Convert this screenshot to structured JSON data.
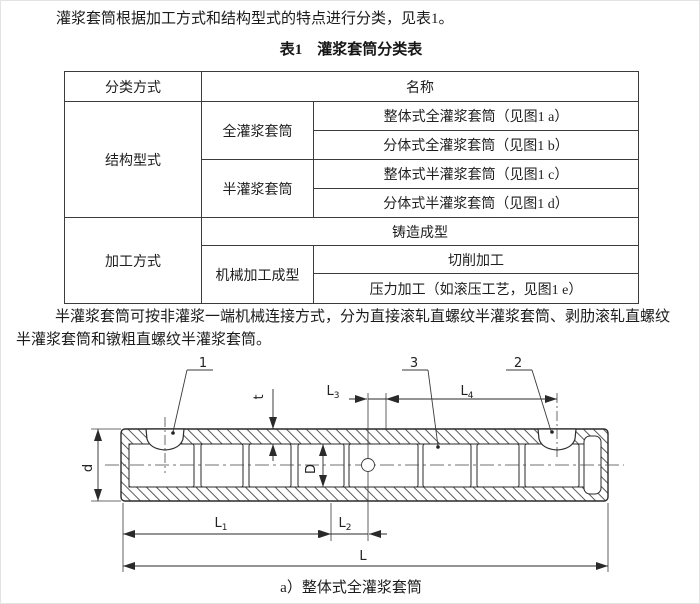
{
  "document": {
    "intro": "灌浆套筒根据加工方式和结构型式的特点进行分类，见表1。",
    "paragraph_lines": [
      "半灌浆套筒可按非灌浆一端机械连接方式，分为直接滚轧直螺纹半灌浆套筒、剥肋滚轧直螺纹",
      "半灌浆套筒和镦粗直螺纹半灌浆套筒。"
    ]
  },
  "table": {
    "title": "表1　灌浆套筒分类表",
    "header": {
      "classification": "分类方式",
      "name": "名称"
    },
    "structure": {
      "label": "结构型式",
      "full": {
        "label": "全灌浆套筒",
        "integral": "整体式全灌浆套筒（见图1 a）",
        "split": "分体式全灌浆套筒（见图1 b）"
      },
      "half": {
        "label": "半灌浆套筒",
        "integral": "整体式半灌浆套筒（见图1 c）",
        "split": "分体式半灌浆套筒（见图1 d）"
      }
    },
    "process": {
      "label": "加工方式",
      "casting": "铸造成型",
      "machining": {
        "label": "机械加工成型",
        "cutting": "切削加工",
        "pressing": "压力加工（如滚压工艺，见图1 e）"
      }
    }
  },
  "figure": {
    "caption": "a）整体式全灌浆套筒",
    "part_labels": {
      "inlet": "1",
      "outlet": "2",
      "rib": "3"
    },
    "dimensions": {
      "outer_diameter": {
        "main": "d"
      },
      "inner_diameter": {
        "main": "D"
      },
      "wall_thickness": {
        "main": "t"
      },
      "L1": {
        "main": "L",
        "sub": "1"
      },
      "L2": {
        "main": "L",
        "sub": "2"
      },
      "L3": {
        "main": "L",
        "sub": "3"
      },
      "L4": {
        "main": "L",
        "sub": "4"
      },
      "total_length": {
        "main": "L"
      }
    }
  },
  "colors": {
    "page_background": "#ffffff",
    "text": "#1b1b1b",
    "table_border": "#3c3c3c",
    "drawing_line": "#2a2a2a"
  }
}
